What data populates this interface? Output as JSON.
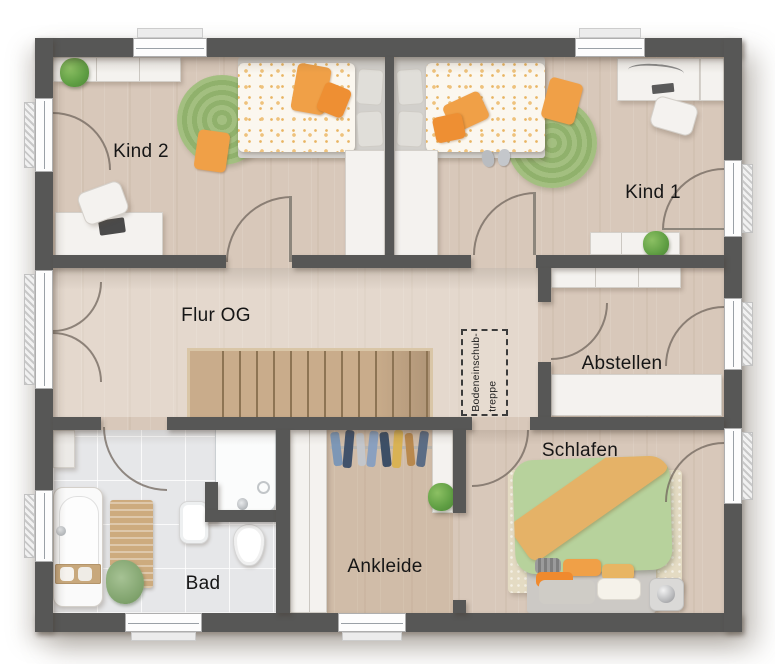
{
  "floorplan": {
    "rooms": {
      "kind2": "Kind 2",
      "kind1": "Kind 1",
      "flur": "Flur OG",
      "abstellen": "Abstellen",
      "bad": "Bad",
      "ankleide": "Ankleide",
      "schlafen": "Schlafen"
    },
    "attic_hatch": {
      "line1": "Bodeneinschub-",
      "line2": "treppe"
    },
    "colors": {
      "wall": "#575756",
      "floor_wood": "#d8c8ba",
      "floor_corridor": "#ddd1c4",
      "floor_tile": "#e6e7e9",
      "floor_ankleide": "#cdb9a3",
      "stairs_wood": "#c9ac8b",
      "rug_green": "#9db878",
      "rug_cream": "#e4dbc3",
      "accent_orange": "#ef9b3f",
      "bedding_green": "#b7d29c",
      "furniture_white": "#f4f2ef",
      "plant_green": "#5f9e43"
    }
  }
}
